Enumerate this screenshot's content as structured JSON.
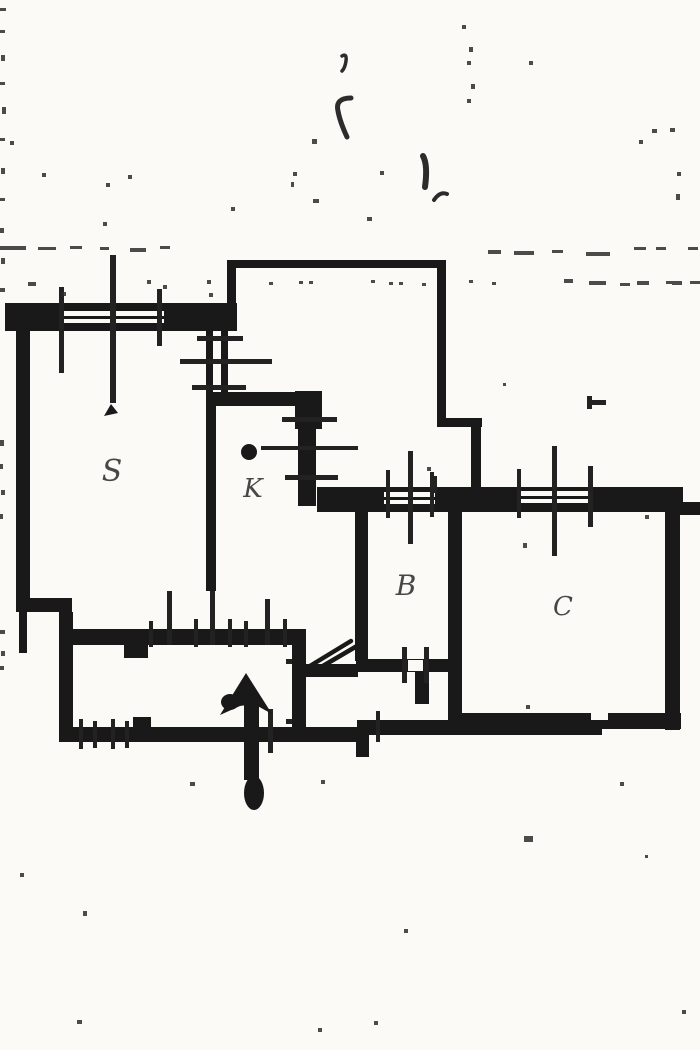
{
  "meta": {
    "title": "Scanned floor plan",
    "type": "floor-plan",
    "description": "Black-and-white scanned cadastral floor plan with handwritten room labels and an entrance arrow pointing up"
  },
  "colors": {
    "background": "#fbfaf6",
    "ink": "#191919",
    "label_ink": "#474747",
    "noise_ink": "#2c2c2c"
  },
  "rooms": [
    {
      "id": "s",
      "label": "S",
      "x": 112,
      "y": 481,
      "size": 30
    },
    {
      "id": "k",
      "label": "K",
      "x": 253,
      "y": 497,
      "size": 26
    },
    {
      "id": "b",
      "label": "B",
      "x": 406,
      "y": 595,
      "size": 28
    },
    {
      "id": "c",
      "label": "C",
      "x": 563,
      "y": 615,
      "size": 26
    }
  ],
  "entrance_arrow": {
    "meaning": "entrance direction arrow",
    "head_points": "246,673 272,714 254,704 240,706 220,715",
    "head_blob": {
      "cx": 230,
      "cy": 702,
      "rx": 9,
      "ry": 8
    },
    "shaft": {
      "x": 244,
      "y": 702,
      "w": 15,
      "h": 78
    },
    "tail_blob": {
      "cx": 254,
      "cy": 793,
      "rx": 10,
      "ry": 17
    }
  },
  "plan": {
    "thick_walls": [
      [
        5,
        303,
        232,
        28
      ],
      [
        16,
        326,
        14,
        282
      ],
      [
        16,
        598,
        56,
        14
      ],
      [
        59,
        612,
        14,
        130
      ],
      [
        19,
        608,
        8,
        45
      ],
      [
        66,
        629,
        231,
        16
      ],
      [
        124,
        645,
        24,
        13
      ],
      [
        292,
        629,
        14,
        113
      ],
      [
        300,
        664,
        58,
        13
      ],
      [
        356,
        659,
        102,
        13
      ],
      [
        415,
        672,
        14,
        32
      ],
      [
        59,
        727,
        302,
        15
      ],
      [
        133,
        717,
        18,
        12
      ],
      [
        357,
        720,
        245,
        15
      ],
      [
        356,
        733,
        13,
        24
      ],
      [
        455,
        713,
        226,
        16
      ],
      [
        355,
        505,
        13,
        156
      ],
      [
        448,
        505,
        14,
        226
      ],
      [
        665,
        509,
        15,
        221
      ],
      [
        317,
        487,
        366,
        25
      ],
      [
        677,
        502,
        23,
        13
      ],
      [
        206,
        392,
        101,
        14
      ],
      [
        295,
        391,
        27,
        38
      ],
      [
        298,
        428,
        18,
        78
      ],
      [
        206,
        330,
        7,
        64
      ],
      [
        221,
        330,
        7,
        64
      ],
      [
        206,
        405,
        10,
        186
      ]
    ],
    "thin_walls": [
      [
        227,
        260,
        218,
        8
      ],
      [
        227,
        260,
        9,
        46
      ],
      [
        437,
        260,
        9,
        165
      ],
      [
        437,
        418,
        45,
        9
      ],
      [
        471,
        418,
        10,
        74
      ]
    ],
    "white_patches": [
      [
        64,
        311,
        100,
        12
      ],
      [
        384,
        492,
        51,
        12
      ],
      [
        521,
        491,
        67,
        12
      ],
      [
        408,
        660,
        15,
        11
      ],
      [
        591,
        713,
        17,
        7
      ]
    ],
    "mid_lines": [
      [
        64,
        316,
        100,
        3
      ],
      [
        384,
        497,
        51,
        3
      ],
      [
        521,
        496,
        67,
        3
      ]
    ],
    "ticks": [
      [
        59,
        287,
        5,
        86
      ],
      [
        157,
        289,
        5,
        57
      ],
      [
        110,
        255,
        6,
        148
      ],
      [
        197,
        336,
        46,
        5
      ],
      [
        180,
        359,
        92,
        5
      ],
      [
        192,
        385,
        54,
        5
      ],
      [
        282,
        417,
        55,
        5
      ],
      [
        261,
        446,
        97,
        4
      ],
      [
        285,
        475,
        53,
        5
      ],
      [
        149,
        621,
        4,
        26
      ],
      [
        167,
        591,
        5,
        54
      ],
      [
        194,
        619,
        4,
        28
      ],
      [
        210,
        591,
        5,
        54
      ],
      [
        228,
        619,
        4,
        28
      ],
      [
        244,
        621,
        4,
        26
      ],
      [
        265,
        599,
        5,
        46
      ],
      [
        283,
        619,
        4,
        28
      ],
      [
        286,
        659,
        6,
        5
      ],
      [
        286,
        719,
        6,
        5
      ],
      [
        402,
        647,
        5,
        36
      ],
      [
        424,
        647,
        5,
        36
      ],
      [
        79,
        719,
        4,
        30
      ],
      [
        93,
        721,
        4,
        27
      ],
      [
        111,
        719,
        4,
        30
      ],
      [
        125,
        721,
        4,
        27
      ],
      [
        376,
        711,
        4,
        31
      ],
      [
        268,
        709,
        5,
        44
      ],
      [
        386,
        470,
        4,
        48
      ],
      [
        408,
        451,
        5,
        93
      ],
      [
        430,
        472,
        4,
        45
      ],
      [
        517,
        469,
        4,
        49
      ],
      [
        552,
        446,
        5,
        110
      ],
      [
        588,
        466,
        5,
        61
      ],
      [
        433,
        476,
        4,
        17
      ],
      [
        587,
        396,
        5,
        13
      ],
      [
        592,
        400,
        14,
        5
      ]
    ],
    "diagonals": [
      [
        305,
        669,
        351,
        641
      ],
      [
        316,
        670,
        357,
        646
      ]
    ],
    "mullion_tip": "111,404 104,416 118,413",
    "blobs": [
      {
        "cx": 249,
        "cy": 452,
        "rx": 8,
        "ry": 8
      }
    ],
    "squiggles": [
      {
        "d": "M342,56 q5,-3 4,5 q-1,7 -4,10",
        "w": 3.5
      },
      {
        "d": "M351,98 q-16,0 -13,13 q2,11 9,26",
        "w": 5
      },
      {
        "d": "M423,156 q5,9 2,31",
        "w": 6
      },
      {
        "d": "M434,200 q6,-9 13,-6",
        "w": 4
      }
    ],
    "noise": [
      [
        0,
        8,
        6,
        3
      ],
      [
        0,
        30,
        5,
        3
      ],
      [
        1,
        55,
        4,
        6
      ],
      [
        0,
        82,
        5,
        3
      ],
      [
        2,
        107,
        4,
        7
      ],
      [
        0,
        138,
        5,
        3
      ],
      [
        1,
        168,
        4,
        6
      ],
      [
        0,
        198,
        5,
        3
      ],
      [
        0,
        228,
        4,
        5
      ],
      [
        1,
        258,
        4,
        6
      ],
      [
        0,
        288,
        5,
        4
      ],
      [
        0,
        440,
        4,
        6
      ],
      [
        0,
        464,
        3,
        5
      ],
      [
        1,
        490,
        4,
        5
      ],
      [
        0,
        514,
        3,
        5
      ],
      [
        0,
        630,
        5,
        4
      ],
      [
        1,
        651,
        4,
        5
      ],
      [
        0,
        666,
        4,
        4
      ],
      [
        0,
        246,
        26,
        4
      ],
      [
        38,
        247,
        18,
        3
      ],
      [
        70,
        246,
        12,
        3
      ],
      [
        100,
        247,
        9,
        3
      ],
      [
        130,
        248,
        16,
        4
      ],
      [
        160,
        246,
        10,
        3
      ],
      [
        488,
        250,
        13,
        4
      ],
      [
        514,
        251,
        20,
        4
      ],
      [
        552,
        250,
        11,
        3
      ],
      [
        586,
        252,
        24,
        4
      ],
      [
        634,
        247,
        12,
        3
      ],
      [
        656,
        247,
        10,
        3
      ],
      [
        688,
        247,
        10,
        3
      ],
      [
        564,
        279,
        9,
        4
      ],
      [
        589,
        281,
        17,
        4
      ],
      [
        620,
        283,
        10,
        3
      ],
      [
        637,
        281,
        12,
        4
      ],
      [
        666,
        281,
        6,
        3
      ],
      [
        672,
        281,
        10,
        4
      ],
      [
        690,
        281,
        10,
        3
      ],
      [
        207,
        280,
        4,
        4
      ],
      [
        269,
        282,
        4,
        3
      ],
      [
        299,
        281,
        4,
        3
      ],
      [
        309,
        281,
        4,
        3
      ],
      [
        371,
        280,
        4,
        3
      ],
      [
        389,
        282,
        4,
        3
      ],
      [
        399,
        282,
        4,
        3
      ],
      [
        422,
        283,
        4,
        3
      ],
      [
        469,
        280,
        4,
        3
      ],
      [
        492,
        282,
        4,
        3
      ],
      [
        462,
        25,
        4,
        4
      ],
      [
        469,
        47,
        4,
        5
      ],
      [
        467,
        61,
        4,
        4
      ],
      [
        471,
        84,
        4,
        5
      ],
      [
        467,
        99,
        4,
        4
      ],
      [
        529,
        61,
        4,
        4
      ],
      [
        652,
        129,
        5,
        4
      ],
      [
        670,
        128,
        5,
        4
      ],
      [
        639,
        140,
        4,
        4
      ],
      [
        677,
        172,
        4,
        4
      ],
      [
        676,
        194,
        4,
        6
      ],
      [
        312,
        139,
        5,
        5
      ],
      [
        293,
        172,
        4,
        4
      ],
      [
        291,
        182,
        3,
        5
      ],
      [
        313,
        199,
        6,
        4
      ],
      [
        380,
        171,
        4,
        4
      ],
      [
        367,
        217,
        5,
        4
      ],
      [
        128,
        175,
        4,
        4
      ],
      [
        42,
        173,
        4,
        4
      ],
      [
        10,
        141,
        4,
        4
      ],
      [
        106,
        183,
        4,
        4
      ],
      [
        231,
        207,
        4,
        4
      ],
      [
        103,
        222,
        4,
        4
      ],
      [
        28,
        282,
        8,
        4
      ],
      [
        62,
        292,
        4,
        4
      ],
      [
        147,
        280,
        4,
        4
      ],
      [
        163,
        285,
        4,
        4
      ],
      [
        209,
        293,
        4,
        4
      ],
      [
        427,
        467,
        4,
        4
      ],
      [
        523,
        543,
        4,
        5
      ],
      [
        526,
        705,
        4,
        4
      ],
      [
        503,
        383,
        3,
        3
      ],
      [
        645,
        515,
        4,
        4
      ],
      [
        190,
        782,
        5,
        4
      ],
      [
        321,
        780,
        4,
        4
      ],
      [
        620,
        782,
        4,
        4
      ],
      [
        524,
        836,
        9,
        6
      ],
      [
        83,
        911,
        4,
        5
      ],
      [
        404,
        929,
        4,
        4
      ],
      [
        77,
        1020,
        5,
        4
      ],
      [
        374,
        1021,
        4,
        4
      ],
      [
        682,
        1010,
        4,
        4
      ],
      [
        20,
        873,
        4,
        4
      ],
      [
        645,
        855,
        3,
        3
      ],
      [
        318,
        1028,
        4,
        4
      ]
    ]
  }
}
